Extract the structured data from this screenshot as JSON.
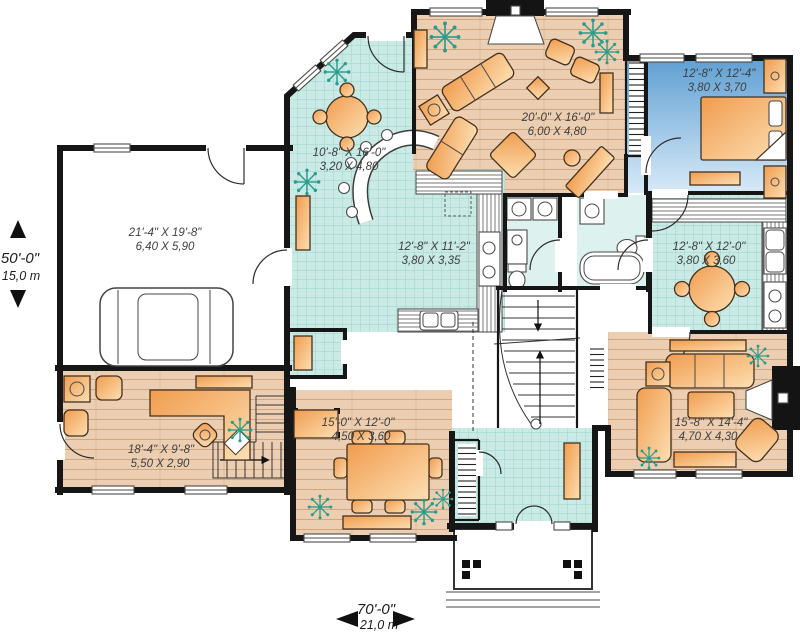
{
  "plan": {
    "overall": {
      "depth_imperial": "50'-0\"",
      "depth_metric": "15,0 m",
      "width_imperial": "70'-0\"",
      "width_metric": "21,0 m"
    },
    "rooms": [
      {
        "id": "garage",
        "imperial": "21'-4\" X 19'-8\"",
        "metric": "6,40 X 5,90"
      },
      {
        "id": "breakfast-nook",
        "imperial": "10'-8\" X 16'-0\"",
        "metric": "3,20 X 4,80"
      },
      {
        "id": "living-room",
        "imperial": "20'-0\" X 16'-0\"",
        "metric": "6,00 X 4,80"
      },
      {
        "id": "bedroom",
        "imperial": "12'-8\" X 12'-4\"",
        "metric": "3,80 X 3,70"
      },
      {
        "id": "kitchen",
        "imperial": "12'-8\" X 11'-2\"",
        "metric": "3,80 X 3,35"
      },
      {
        "id": "dinette",
        "imperial": "12'-8\" X 12'-0\"",
        "metric": "3,80 X 3,60"
      },
      {
        "id": "office",
        "imperial": "18'-4\" X 9'-8\"",
        "metric": "5,50 X 2,90"
      },
      {
        "id": "dining-room",
        "imperial": "15'-0\" X 12'-0\"",
        "metric": "4,50 X 3,60"
      },
      {
        "id": "family-room",
        "imperial": "15'-8\" X 14'-4\"",
        "metric": "4,70 X 4,30"
      }
    ],
    "colors": {
      "tile": "#c9eae5",
      "wood": "#eccfb2",
      "bedroom_blue": "#5f9fd3",
      "furniture": "#f5a85f",
      "wall": "#161616",
      "plant": "#2b9b8d"
    }
  }
}
